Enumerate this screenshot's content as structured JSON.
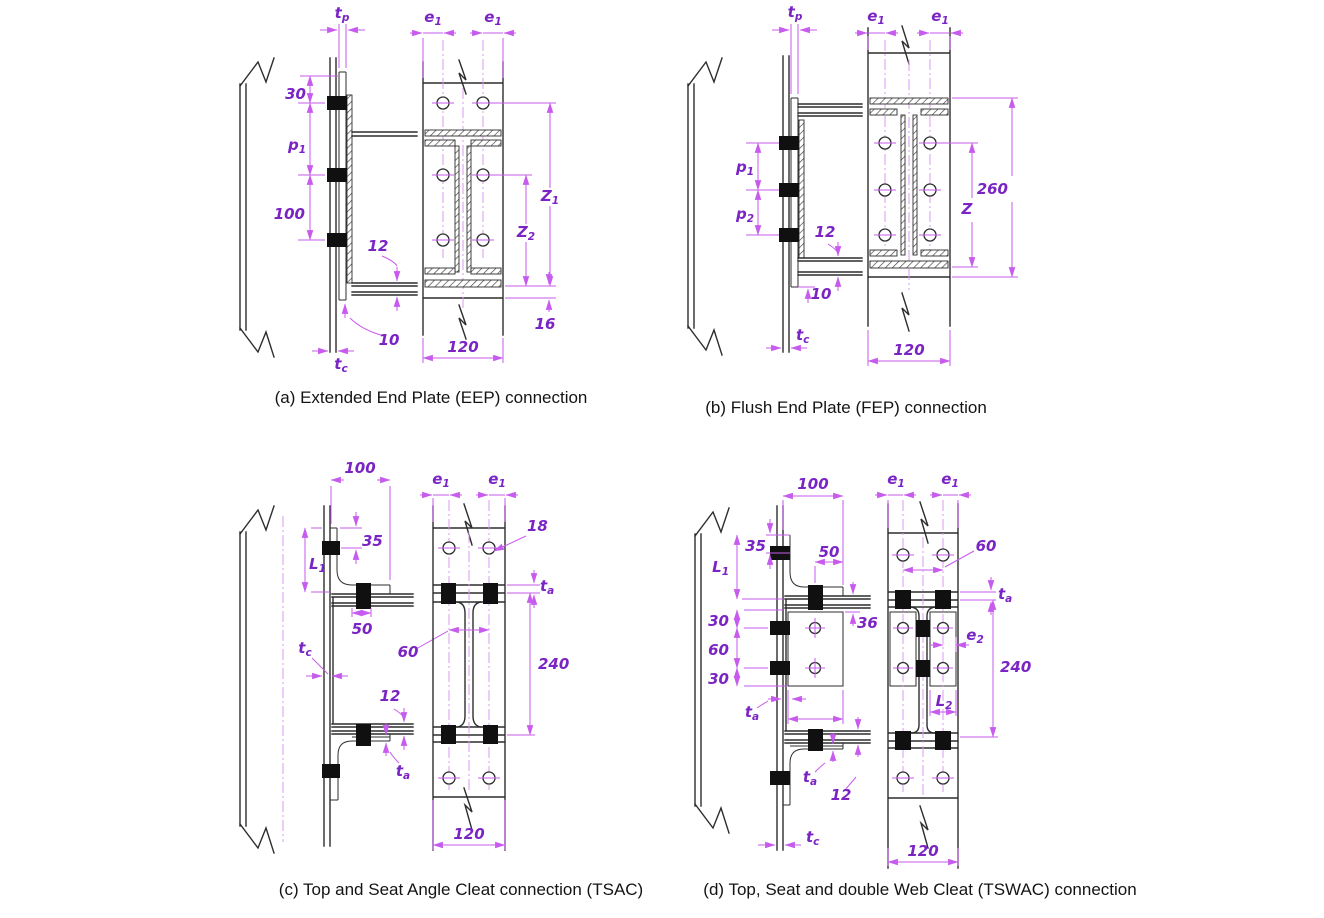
{
  "figure_title": "Steel beam-to-column connection details",
  "symbols": {
    "tp": {
      "base": "t",
      "sub": "p"
    },
    "tc": {
      "base": "t",
      "sub": "c"
    },
    "ta": {
      "base": "t",
      "sub": "a"
    },
    "e1": {
      "base": "e",
      "sub": "1"
    },
    "e2": {
      "base": "e",
      "sub": "2"
    },
    "p1": {
      "base": "p",
      "sub": "1"
    },
    "p2": {
      "base": "p",
      "sub": "2"
    },
    "z1": {
      "base": "Z",
      "sub": "1"
    },
    "z2": {
      "base": "Z",
      "sub": "2"
    },
    "z": {
      "base": "Z",
      "sub": ""
    },
    "L1": {
      "base": "L",
      "sub": "1"
    },
    "L2": {
      "base": "L",
      "sub": "2"
    }
  },
  "panels": {
    "a": {
      "caption": "(a) Extended End Plate (EEP) connection",
      "dims": {
        "top_edge": "30",
        "pitch": "100",
        "flange_thk": "12",
        "plate_ext": "10",
        "width": "120",
        "bottom_ext": "16"
      }
    },
    "b": {
      "caption": "(b) Flush End Plate (FEP) connection",
      "dims": {
        "flange_thk": "12",
        "plate_ext": "10",
        "width": "120",
        "plate_height": "260"
      }
    },
    "c": {
      "caption": "(c) Top and Seat Angle Cleat connection (TSAC)",
      "dims": {
        "leg": "100",
        "top_offset": "35",
        "seat_edge": "50",
        "gauge": "60",
        "flange_thk": "12",
        "hole_dia": "18",
        "depth": "240",
        "width": "120"
      }
    },
    "d": {
      "caption": "(d) Top, Seat  and double Web Cleat (TSWAC) connection",
      "dims": {
        "leg": "100",
        "top_offset": "35",
        "cleat_edge": "50",
        "s_top": "30",
        "s_mid": "60",
        "s_bot": "30",
        "gap": "36",
        "flange_thk": "12",
        "gauge": "60",
        "depth": "240",
        "width": "120"
      }
    }
  },
  "colors": {
    "dimension_line": "#c75bed",
    "dimension_text": "#7b24c4",
    "drawing_line": "#2d2d2d",
    "bolt": "#101010"
  }
}
